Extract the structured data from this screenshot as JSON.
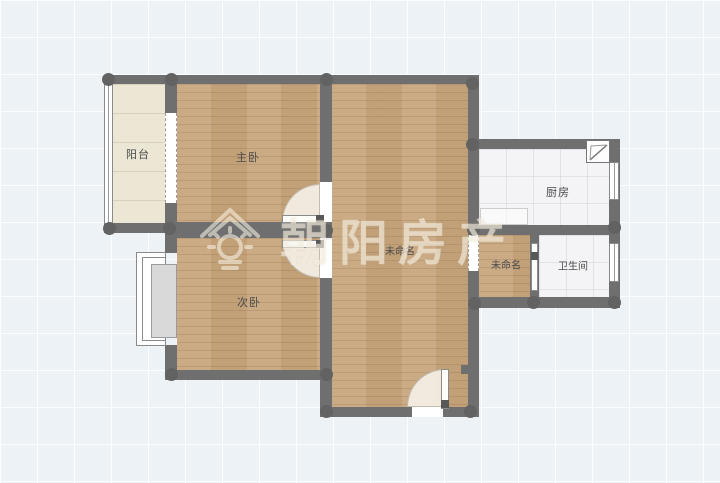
{
  "floorplan": {
    "watermark": {
      "text": "朝阳房产",
      "logo": "house-sun-logo"
    },
    "rooms": [
      {
        "id": "balcony",
        "label": "阳台"
      },
      {
        "id": "master-bedroom",
        "label": "主卧"
      },
      {
        "id": "hall",
        "label": "未命名"
      },
      {
        "id": "second-bedroom",
        "label": "次卧"
      },
      {
        "id": "kitchen",
        "label": "厨房"
      },
      {
        "id": "utility",
        "label": "未命名"
      },
      {
        "id": "bathroom",
        "label": "卫生间"
      }
    ],
    "colors": {
      "wall": "#6f6f6f",
      "wood_floor": "#c8a67d",
      "balcony_floor": "#ece6d5",
      "tile_floor": "#f4f4f6",
      "background": "#edf2f6",
      "watermark": "#f8f2e4"
    }
  }
}
